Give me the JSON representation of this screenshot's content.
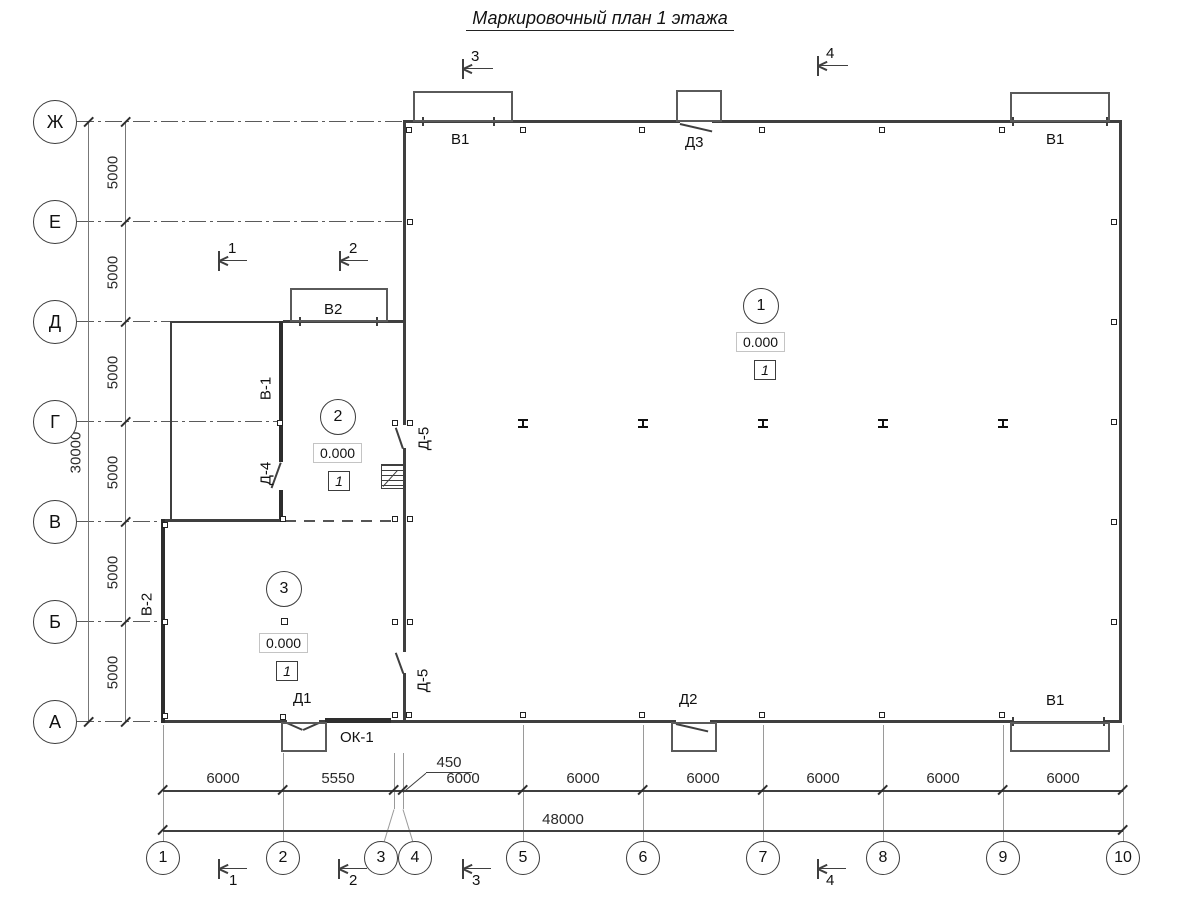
{
  "title": "Маркировочный план 1 этажа",
  "axis_letters": [
    "Ж",
    "Е",
    "Д",
    "Г",
    "В",
    "Б",
    "А"
  ],
  "axis_numbers": [
    "1",
    "2",
    "3",
    "4",
    "5",
    "6",
    "7",
    "8",
    "9",
    "10"
  ],
  "dims": {
    "left_total": "30000",
    "left_5000": "5000",
    "bottom": [
      "6000",
      "5550",
      "6000",
      "6000",
      "6000",
      "6000",
      "6000",
      "6000"
    ],
    "offset_450": "450",
    "bottom_total": "48000"
  },
  "openings": {
    "v1": "В1",
    "d3": "Д3",
    "v2": "В2",
    "v_1": "В-1",
    "d_4": "Д-4",
    "d_5": "Д-5",
    "v_2": "В-2",
    "d1": "Д1",
    "ok1": "ОК-1",
    "d2": "Д2"
  },
  "rooms": [
    {
      "num": "1",
      "elev": "0.000",
      "finish": "1"
    },
    {
      "num": "2",
      "elev": "0.000",
      "finish": "1"
    },
    {
      "num": "3",
      "elev": "0.000",
      "finish": "1"
    }
  ],
  "sections": {
    "s1": "1",
    "s2": "2",
    "s3": "3",
    "s4": "4"
  }
}
